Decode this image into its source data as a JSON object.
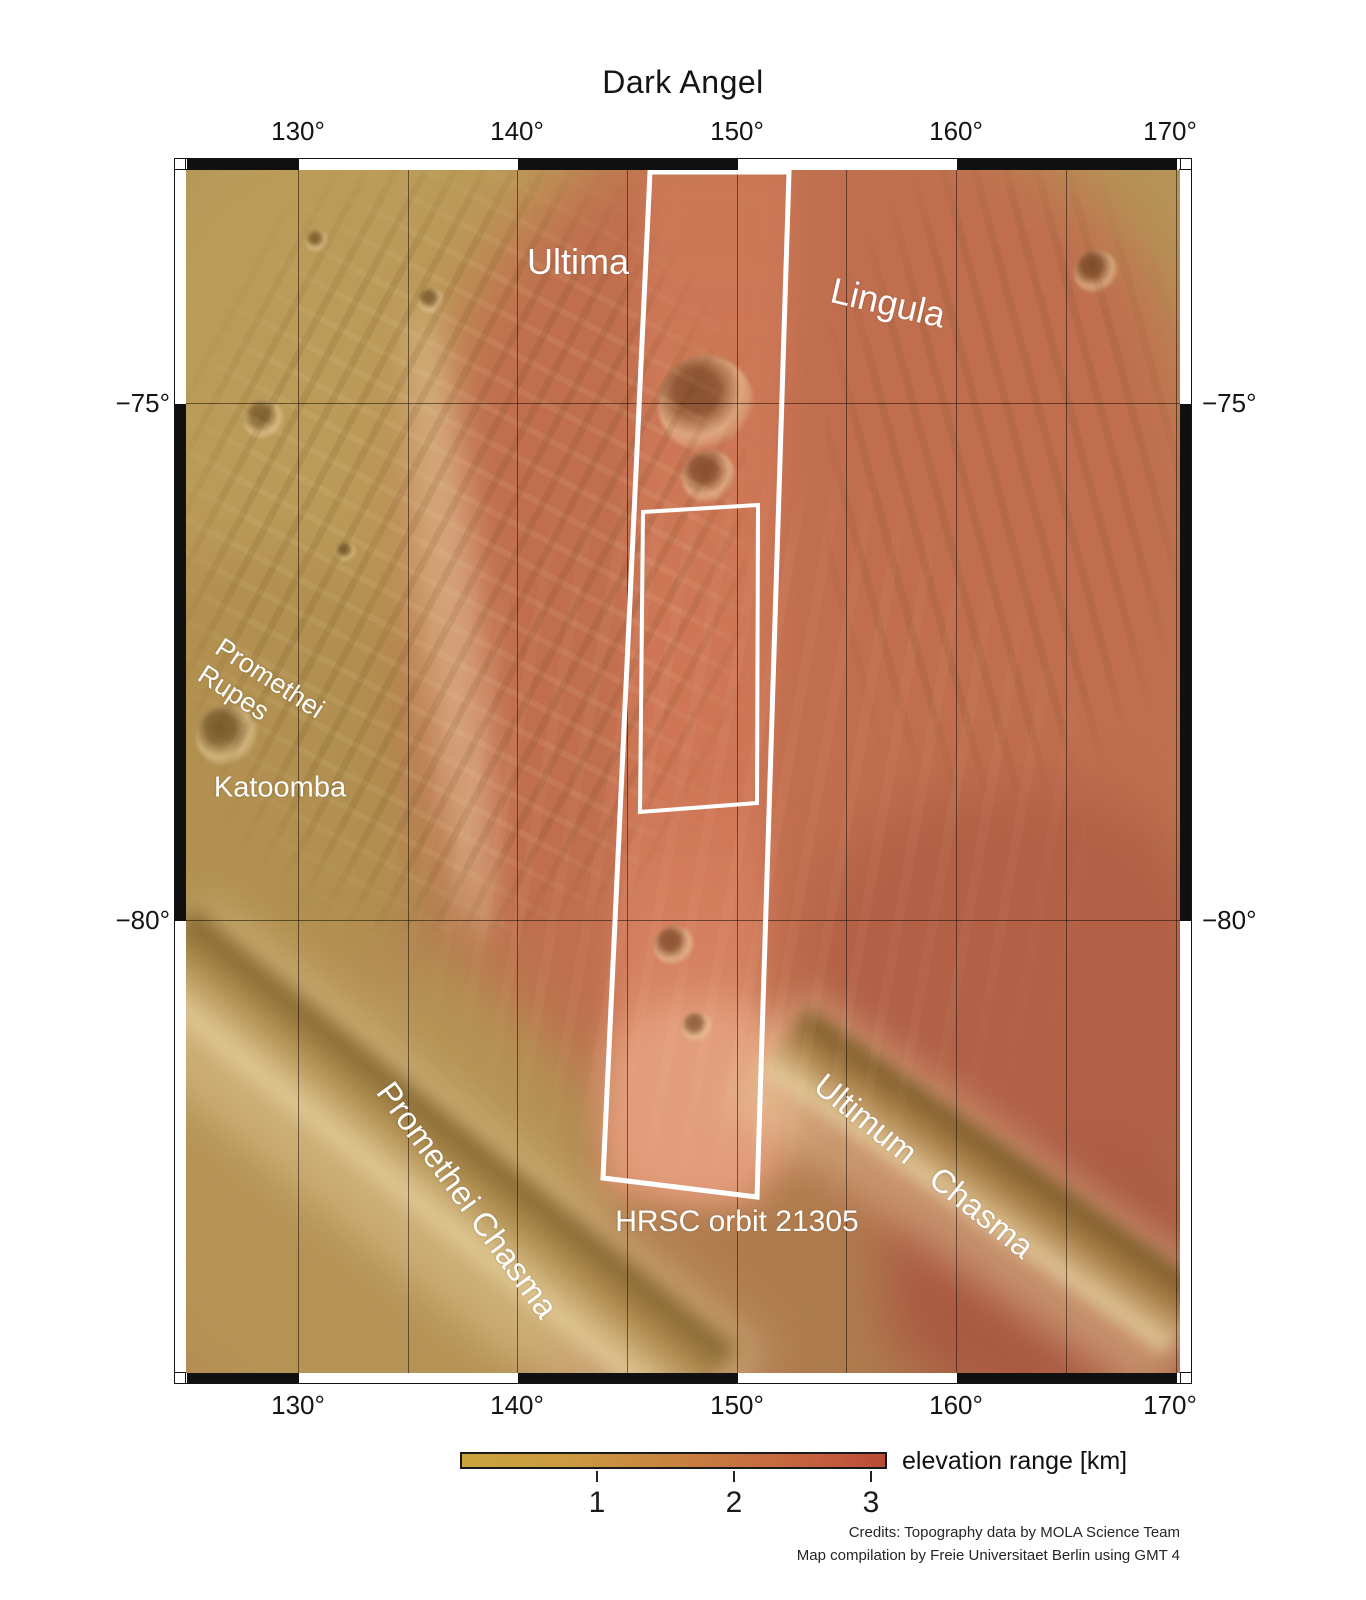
{
  "title": "Dark Angel",
  "axes": {
    "lon_ticks": [
      "130°",
      "140°",
      "150°",
      "160°",
      "170°"
    ],
    "lat_ticks": [
      "−75°",
      "−80°"
    ]
  },
  "map_labels": {
    "ultima": "Ultima",
    "lingula": "Lingula",
    "promethei_rupes": {
      "line1": "Promethei",
      "line2": "Rupes"
    },
    "katoomba": "Katoomba",
    "promethei_chasma": "Promethei Chasma",
    "ultimum_chasma": "Ultimum Chasma",
    "hrsc_orbit": "HRSC orbit 21305"
  },
  "legend": {
    "label": "elevation range [km]",
    "tick_values": [
      "1",
      "2",
      "3"
    ]
  },
  "credits": {
    "line1": "Credits: Topography data by MOLA Science Team",
    "line2": "Map compilation by Freie Universitaet Berlin using GMT 4"
  },
  "colors": {
    "elevation_low": "#c9a43d",
    "elevation_mid": "#c8823f",
    "elevation_high": "#b84a37",
    "terrain_tan": "#b3924f",
    "terrain_red": "#c06e4e",
    "footprint_outline": "#ffffff",
    "frame_black": "#101010"
  }
}
